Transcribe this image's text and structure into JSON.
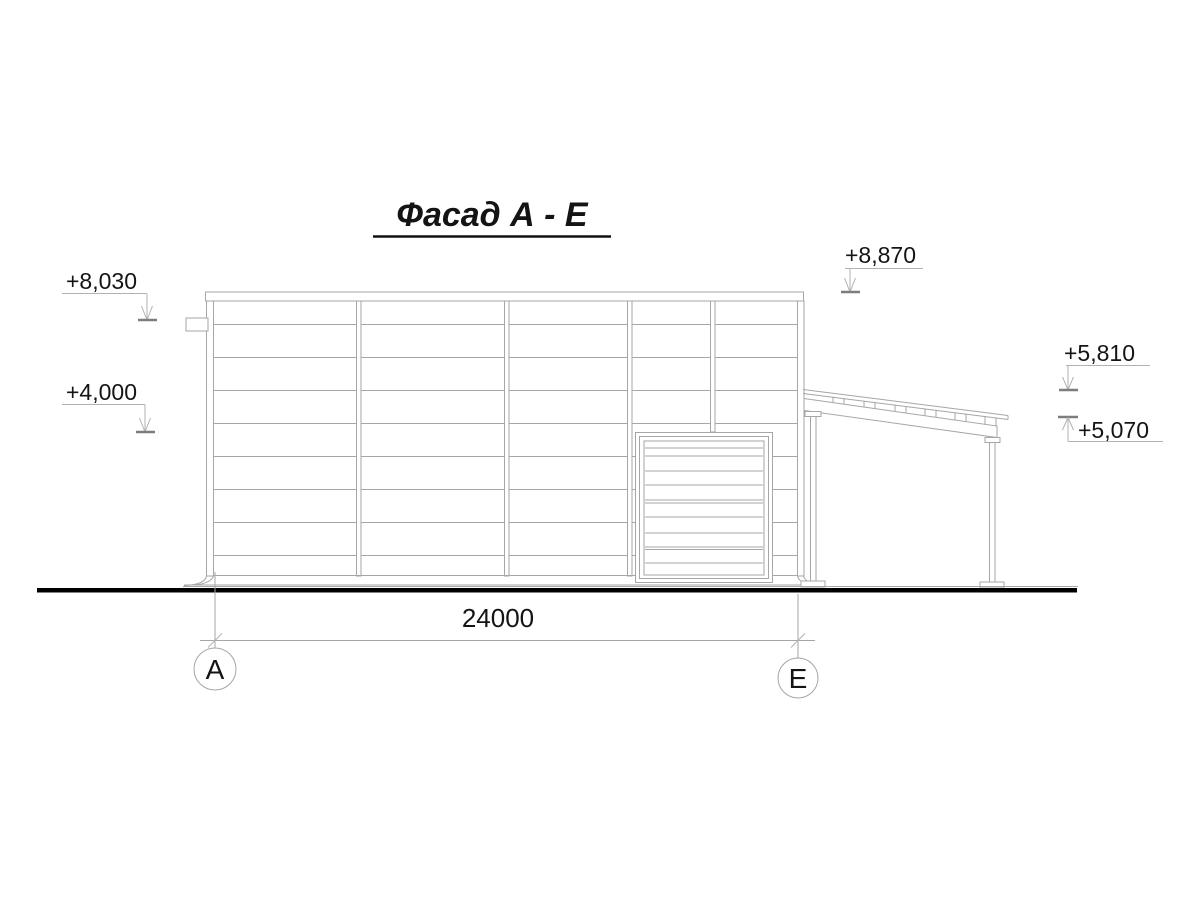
{
  "drawing": {
    "title": "Фасад А - Е",
    "dimension_label": "24000",
    "axis_left": "А",
    "axis_right": "Е",
    "marks": {
      "m8030": "+8,030",
      "m4000": "+4,000",
      "m8870": "+8,870",
      "m5810": "+5,810",
      "m5070": "+5,070"
    },
    "colors": {
      "line": "#a6a6a6",
      "level_tick": "#7d7d7d",
      "ground_line": "#000000",
      "text": "#141414",
      "background": "#ffffff"
    }
  }
}
